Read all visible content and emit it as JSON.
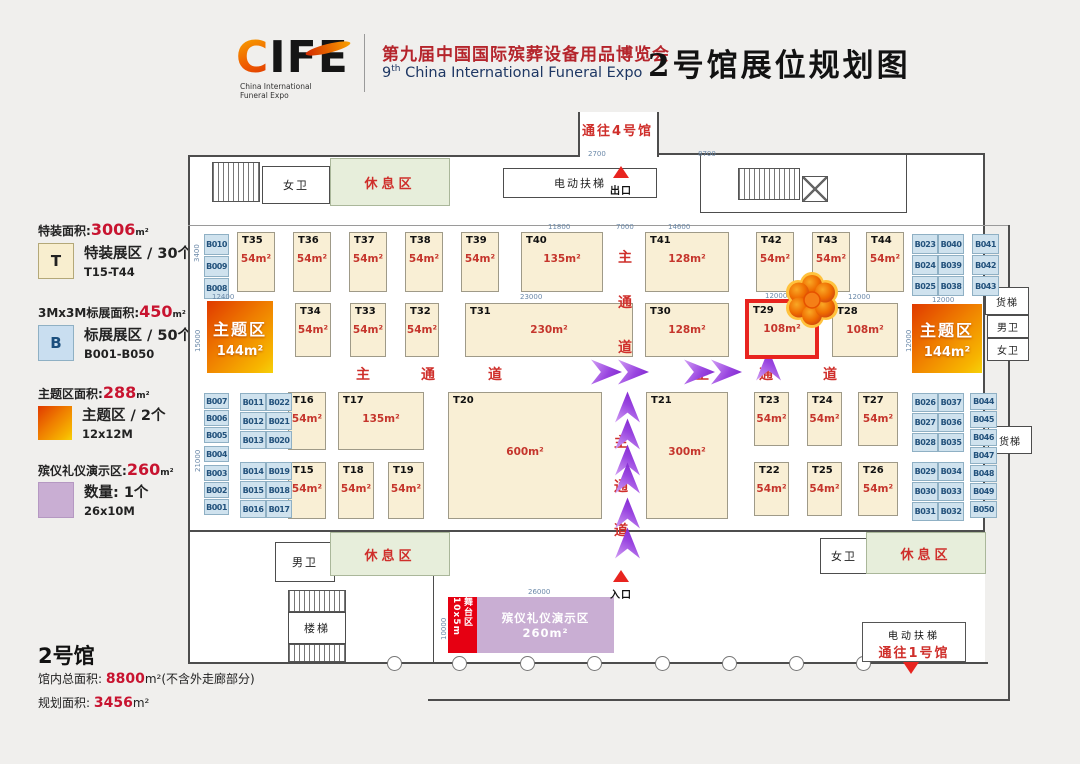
{
  "header": {
    "logo": {
      "c": "C",
      "rest": "IFE",
      "tag1": "China International",
      "tag2": "Funeral Expo"
    },
    "title_cn": "第九届中国国际殡葬设备用品博览会",
    "title_en_num": "9",
    "title_en_sup": "th",
    "title_en_rest": " China International Funeral Expo",
    "hall_title": "2号馆展位规划图"
  },
  "legend": {
    "items": [
      {
        "stat_label": "特装面积:",
        "stat_value": "3006",
        "unit": "m²",
        "swatch": "T",
        "line1": "特装展区 / 30个",
        "line2": "T15-T44"
      },
      {
        "stat_label": "3Mx3M标展面积:",
        "stat_value": "450",
        "unit": "m²",
        "swatch": "B",
        "line1": "标展展区 / 50个",
        "line2": "B001-B050"
      },
      {
        "stat_label": "主题区面积:",
        "stat_value": "288",
        "unit": "m²",
        "swatch": "",
        "line1": "主题区 / 2个",
        "line2": "12x12M"
      },
      {
        "stat_label": "殡仪礼仪演示区:",
        "stat_value": "260",
        "unit": "m²",
        "swatch": "",
        "line1": "数量: 1个",
        "line2": "26x10M"
      }
    ]
  },
  "hall_info": {
    "name": "2号馆",
    "line1_label": "馆内总面积: ",
    "line1_value": "8800",
    "line1_suffix": "m²(不含外走廊部分)",
    "line2_label": "规划面积: ",
    "line2_value": "3456",
    "line2_suffix": "m²"
  },
  "plan": {
    "labels": {
      "to_hall4": "通往4号馆",
      "exit": "出口",
      "entrance": "入口",
      "wc_women_top": "女卫",
      "rest_top": "休息区",
      "escalator_top": "电动扶梯",
      "freight1": "货梯",
      "wc_men_right": "男卫",
      "wc_women_right": "女卫",
      "freight2": "货梯",
      "wc_men_bottom": "男卫",
      "rest_bottom_left": "休息区",
      "stairs": "楼梯",
      "wc_women_bottom": "女卫",
      "rest_bottom_right": "休息区",
      "escalator_bottom": "电动扶梯",
      "to_hall1": "通往1号馆"
    },
    "stage": {
      "label": "舞台区",
      "size": "10x5m"
    },
    "demo": {
      "label": "殡仪礼仪演示区",
      "area": "260m²"
    },
    "theme_zones": [
      {
        "label": "主题区",
        "area": "144m²",
        "x": 207,
        "y": 301,
        "w": 66,
        "h": 72
      },
      {
        "label": "主题区",
        "area": "144m²",
        "x": 912,
        "y": 304,
        "w": 70,
        "h": 69
      }
    ],
    "booths": [
      {
        "id": "T35",
        "area": "54m²",
        "x": 237,
        "y": 232,
        "w": 38,
        "h": 60
      },
      {
        "id": "T36",
        "area": "54m²",
        "x": 293,
        "y": 232,
        "w": 38,
        "h": 60
      },
      {
        "id": "T37",
        "area": "54m²",
        "x": 349,
        "y": 232,
        "w": 38,
        "h": 60
      },
      {
        "id": "T38",
        "area": "54m²",
        "x": 405,
        "y": 232,
        "w": 38,
        "h": 60
      },
      {
        "id": "T39",
        "area": "54m²",
        "x": 461,
        "y": 232,
        "w": 38,
        "h": 60
      },
      {
        "id": "T40",
        "area": "135m²",
        "x": 521,
        "y": 232,
        "w": 82,
        "h": 60
      },
      {
        "id": "T41",
        "area": "128m²",
        "x": 645,
        "y": 232,
        "w": 84,
        "h": 60
      },
      {
        "id": "T42",
        "area": "54m²",
        "x": 756,
        "y": 232,
        "w": 38,
        "h": 60
      },
      {
        "id": "T43",
        "area": "54m²",
        "x": 812,
        "y": 232,
        "w": 38,
        "h": 60
      },
      {
        "id": "T44",
        "area": "54m²",
        "x": 866,
        "y": 232,
        "w": 38,
        "h": 60
      },
      {
        "id": "T34",
        "area": "54m²",
        "x": 295,
        "y": 303,
        "w": 36,
        "h": 54
      },
      {
        "id": "T33",
        "area": "54m²",
        "x": 350,
        "y": 303,
        "w": 36,
        "h": 54
      },
      {
        "id": "T32",
        "area": "54m²",
        "x": 405,
        "y": 303,
        "w": 34,
        "h": 54
      },
      {
        "id": "T31",
        "area": "230m²",
        "x": 465,
        "y": 303,
        "w": 168,
        "h": 54
      },
      {
        "id": "T30",
        "area": "128m²",
        "x": 645,
        "y": 303,
        "w": 84,
        "h": 54
      },
      {
        "id": "T29",
        "area": "108m²",
        "x": 745,
        "y": 299,
        "w": 74,
        "h": 60,
        "hl": true
      },
      {
        "id": "T28",
        "area": "108m²",
        "x": 832,
        "y": 303,
        "w": 66,
        "h": 54
      },
      {
        "id": "T16",
        "area": "54m²",
        "x": 288,
        "y": 392,
        "w": 38,
        "h": 58
      },
      {
        "id": "T17",
        "area": "135m²",
        "x": 338,
        "y": 392,
        "w": 86,
        "h": 58
      },
      {
        "id": "T20",
        "area": "600m²",
        "x": 448,
        "y": 392,
        "w": 154,
        "h": 127,
        "big": true
      },
      {
        "id": "T21",
        "area": "300m²",
        "x": 646,
        "y": 392,
        "w": 82,
        "h": 127,
        "big": true
      },
      {
        "id": "T23",
        "area": "54m²",
        "x": 754,
        "y": 392,
        "w": 35,
        "h": 54
      },
      {
        "id": "T24",
        "area": "54m²",
        "x": 807,
        "y": 392,
        "w": 35,
        "h": 54
      },
      {
        "id": "T27",
        "area": "54m²",
        "x": 858,
        "y": 392,
        "w": 40,
        "h": 54
      },
      {
        "id": "T15",
        "area": "54m²",
        "x": 288,
        "y": 462,
        "w": 38,
        "h": 57
      },
      {
        "id": "T18",
        "area": "54m²",
        "x": 338,
        "y": 462,
        "w": 36,
        "h": 57
      },
      {
        "id": "T19",
        "area": "54m²",
        "x": 388,
        "y": 462,
        "w": 36,
        "h": 57
      },
      {
        "id": "T22",
        "area": "54m²",
        "x": 754,
        "y": 462,
        "w": 35,
        "h": 54
      },
      {
        "id": "T25",
        "area": "54m²",
        "x": 807,
        "y": 462,
        "w": 35,
        "h": 54
      },
      {
        "id": "T26",
        "area": "54m²",
        "x": 858,
        "y": 462,
        "w": 40,
        "h": 54
      }
    ],
    "b_booths": [
      {
        "id": "B010",
        "x": 204,
        "y": 234,
        "w": 25,
        "h": 21
      },
      {
        "id": "B009",
        "x": 204,
        "y": 256,
        "w": 25,
        "h": 21
      },
      {
        "id": "B008",
        "x": 204,
        "y": 278,
        "w": 25,
        "h": 21
      },
      {
        "id": "B007",
        "x": 204,
        "y": 393,
        "w": 25,
        "h": 16
      },
      {
        "id": "B006",
        "x": 204,
        "y": 410,
        "w": 25,
        "h": 16
      },
      {
        "id": "B005",
        "x": 204,
        "y": 427,
        "w": 25,
        "h": 16
      },
      {
        "id": "B004",
        "x": 204,
        "y": 446,
        "w": 25,
        "h": 16
      },
      {
        "id": "B003",
        "x": 204,
        "y": 465,
        "w": 25,
        "h": 16
      },
      {
        "id": "B002",
        "x": 204,
        "y": 482,
        "w": 25,
        "h": 16
      },
      {
        "id": "B001",
        "x": 204,
        "y": 499,
        "w": 25,
        "h": 16
      },
      {
        "id": "B011",
        "x": 240,
        "y": 393,
        "w": 26,
        "h": 18
      },
      {
        "id": "B022",
        "x": 266,
        "y": 393,
        "w": 26,
        "h": 18
      },
      {
        "id": "B012",
        "x": 240,
        "y": 412,
        "w": 26,
        "h": 18
      },
      {
        "id": "B021",
        "x": 266,
        "y": 412,
        "w": 26,
        "h": 18
      },
      {
        "id": "B013",
        "x": 240,
        "y": 431,
        "w": 26,
        "h": 18
      },
      {
        "id": "B020",
        "x": 266,
        "y": 431,
        "w": 26,
        "h": 18
      },
      {
        "id": "B014",
        "x": 240,
        "y": 462,
        "w": 26,
        "h": 18
      },
      {
        "id": "B019",
        "x": 266,
        "y": 462,
        "w": 26,
        "h": 18
      },
      {
        "id": "B015",
        "x": 240,
        "y": 481,
        "w": 26,
        "h": 18
      },
      {
        "id": "B018",
        "x": 266,
        "y": 481,
        "w": 26,
        "h": 18
      },
      {
        "id": "B016",
        "x": 240,
        "y": 500,
        "w": 26,
        "h": 18
      },
      {
        "id": "B017",
        "x": 266,
        "y": 500,
        "w": 26,
        "h": 18
      },
      {
        "id": "B023",
        "x": 912,
        "y": 234,
        "w": 26,
        "h": 20
      },
      {
        "id": "B040",
        "x": 938,
        "y": 234,
        "w": 26,
        "h": 20
      },
      {
        "id": "B024",
        "x": 912,
        "y": 255,
        "w": 26,
        "h": 20
      },
      {
        "id": "B039",
        "x": 938,
        "y": 255,
        "w": 26,
        "h": 20
      },
      {
        "id": "B025",
        "x": 912,
        "y": 276,
        "w": 26,
        "h": 20
      },
      {
        "id": "B038",
        "x": 938,
        "y": 276,
        "w": 26,
        "h": 20
      },
      {
        "id": "B041",
        "x": 972,
        "y": 234,
        "w": 27,
        "h": 20
      },
      {
        "id": "B042",
        "x": 972,
        "y": 255,
        "w": 27,
        "h": 20
      },
      {
        "id": "B043",
        "x": 972,
        "y": 276,
        "w": 27,
        "h": 20
      },
      {
        "id": "B026",
        "x": 912,
        "y": 393,
        "w": 26,
        "h": 19
      },
      {
        "id": "B037",
        "x": 938,
        "y": 393,
        "w": 26,
        "h": 19
      },
      {
        "id": "B027",
        "x": 912,
        "y": 413,
        "w": 26,
        "h": 19
      },
      {
        "id": "B036",
        "x": 938,
        "y": 413,
        "w": 26,
        "h": 19
      },
      {
        "id": "B028",
        "x": 912,
        "y": 433,
        "w": 26,
        "h": 19
      },
      {
        "id": "B035",
        "x": 938,
        "y": 433,
        "w": 26,
        "h": 19
      },
      {
        "id": "B029",
        "x": 912,
        "y": 462,
        "w": 26,
        "h": 19
      },
      {
        "id": "B034",
        "x": 938,
        "y": 462,
        "w": 26,
        "h": 19
      },
      {
        "id": "B030",
        "x": 912,
        "y": 482,
        "w": 26,
        "h": 19
      },
      {
        "id": "B033",
        "x": 938,
        "y": 482,
        "w": 26,
        "h": 19
      },
      {
        "id": "B031",
        "x": 912,
        "y": 502,
        "w": 26,
        "h": 19
      },
      {
        "id": "B032",
        "x": 938,
        "y": 502,
        "w": 26,
        "h": 19
      },
      {
        "id": "B044",
        "x": 970,
        "y": 393,
        "w": 27,
        "h": 17
      },
      {
        "id": "B045",
        "x": 970,
        "y": 411,
        "w": 27,
        "h": 17
      },
      {
        "id": "B046",
        "x": 970,
        "y": 429,
        "w": 27,
        "h": 17
      },
      {
        "id": "B047",
        "x": 970,
        "y": 447,
        "w": 27,
        "h": 17
      },
      {
        "id": "B048",
        "x": 970,
        "y": 465,
        "w": 27,
        "h": 17
      },
      {
        "id": "B049",
        "x": 970,
        "y": 483,
        "w": 27,
        "h": 17
      },
      {
        "id": "B050",
        "x": 970,
        "y": 501,
        "w": 27,
        "h": 17
      }
    ],
    "aisle_texts": [
      {
        "ch": "主",
        "x": 617,
        "y": 247
      },
      {
        "ch": "通",
        "x": 617,
        "y": 292
      },
      {
        "ch": "道",
        "x": 617,
        "y": 337
      },
      {
        "ch": "主",
        "x": 355,
        "y": 364
      },
      {
        "ch": "通",
        "x": 420,
        "y": 364
      },
      {
        "ch": "道",
        "x": 487,
        "y": 364
      },
      {
        "ch": "主",
        "x": 694,
        "y": 364
      },
      {
        "ch": "通",
        "x": 758,
        "y": 364
      },
      {
        "ch": "道",
        "x": 822,
        "y": 364
      },
      {
        "ch": "主",
        "x": 613,
        "y": 432
      },
      {
        "ch": "通",
        "x": 613,
        "y": 476
      },
      {
        "ch": "道",
        "x": 613,
        "y": 520
      }
    ],
    "arrows": [
      {
        "x": 591,
        "y": 359,
        "dir": "r"
      },
      {
        "x": 618,
        "y": 359,
        "dir": "r"
      },
      {
        "x": 684,
        "y": 359,
        "dir": "r"
      },
      {
        "x": 711,
        "y": 359,
        "dir": "r"
      },
      {
        "x": 753,
        "y": 352,
        "dir": "u"
      },
      {
        "x": 612,
        "y": 394,
        "dir": "u"
      },
      {
        "x": 612,
        "y": 421,
        "dir": "u"
      },
      {
        "x": 612,
        "y": 447,
        "dir": "u"
      },
      {
        "x": 612,
        "y": 465,
        "dir": "u"
      },
      {
        "x": 612,
        "y": 500,
        "dir": "u"
      },
      {
        "x": 612,
        "y": 530,
        "dir": "u"
      }
    ],
    "dims": [
      {
        "t": "12400",
        "x": 212,
        "y": 293
      },
      {
        "t": "23000",
        "x": 520,
        "y": 293
      },
      {
        "t": "11800",
        "x": 548,
        "y": 223
      },
      {
        "t": "7000",
        "x": 616,
        "y": 223
      },
      {
        "t": "14600",
        "x": 668,
        "y": 223
      },
      {
        "t": "12000",
        "x": 765,
        "y": 292
      },
      {
        "t": "12000",
        "x": 848,
        "y": 293
      },
      {
        "t": "12000",
        "x": 932,
        "y": 296
      },
      {
        "t": "2700",
        "x": 588,
        "y": 150
      },
      {
        "t": "8700",
        "x": 698,
        "y": 150
      },
      {
        "t": "26000",
        "x": 528,
        "y": 588
      },
      {
        "t": "10000",
        "x": 440,
        "y": 640,
        "v": true
      },
      {
        "t": "3400",
        "x": 193,
        "y": 262,
        "v": true
      },
      {
        "t": "15000",
        "x": 194,
        "y": 352,
        "v": true
      },
      {
        "t": "21000",
        "x": 194,
        "y": 472,
        "v": true
      },
      {
        "t": "12000",
        "x": 905,
        "y": 352,
        "v": true
      }
    ]
  }
}
